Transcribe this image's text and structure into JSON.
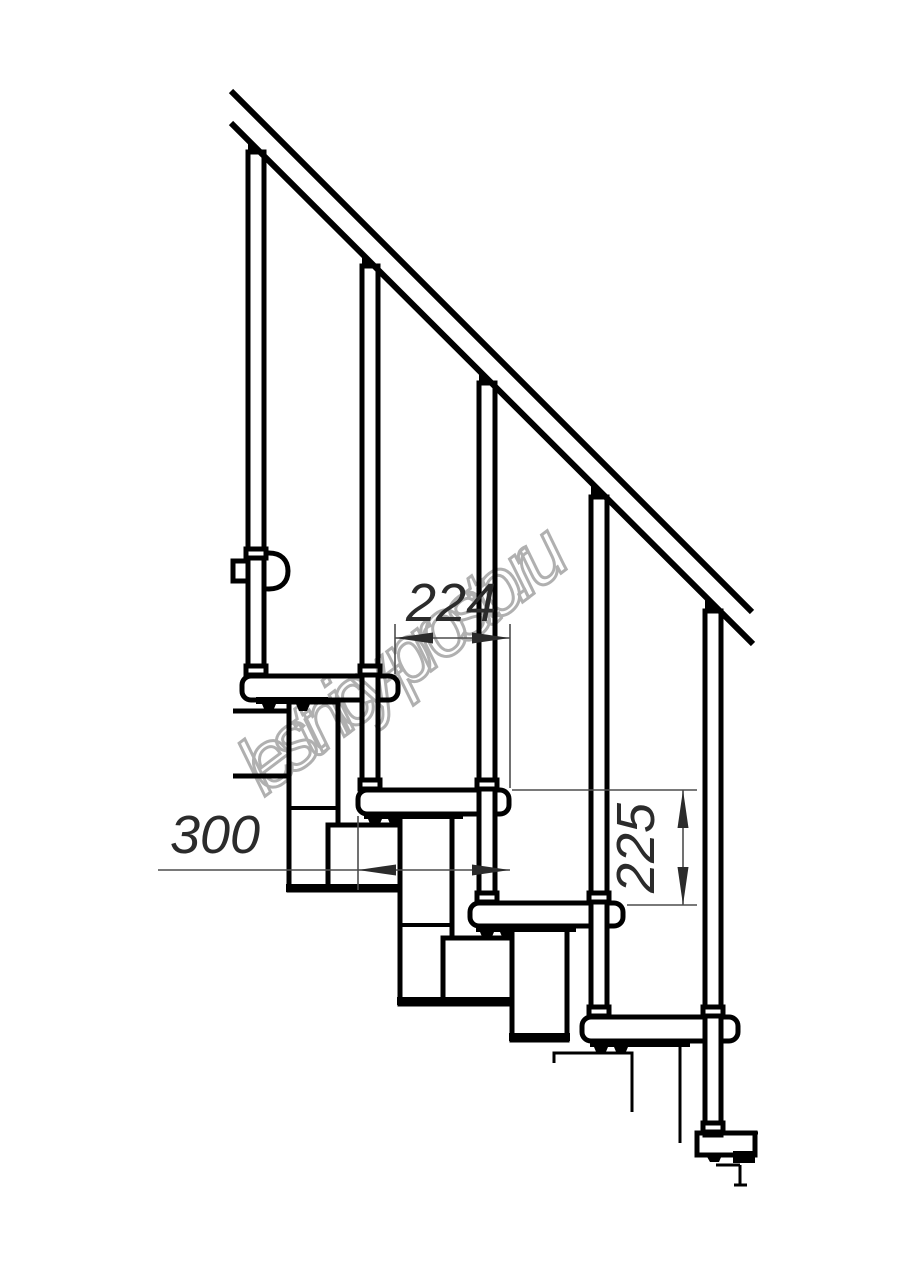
{
  "drawing": {
    "kind": "modular staircase side-view technical drawing",
    "visible_treads": 5,
    "visible_balusters": 5
  },
  "dimensions": {
    "run": {
      "label": "224"
    },
    "depth": {
      "label": "300"
    },
    "rise": {
      "label": "225"
    }
  },
  "watermark": {
    "text": "lestnicy-prosto.ru",
    "color": "#b0b0b0"
  },
  "colors": {
    "line": "#000000",
    "background": "#ffffff",
    "dimension_text": "#2b2b2b",
    "dimension_line": "#4d4d4d"
  }
}
